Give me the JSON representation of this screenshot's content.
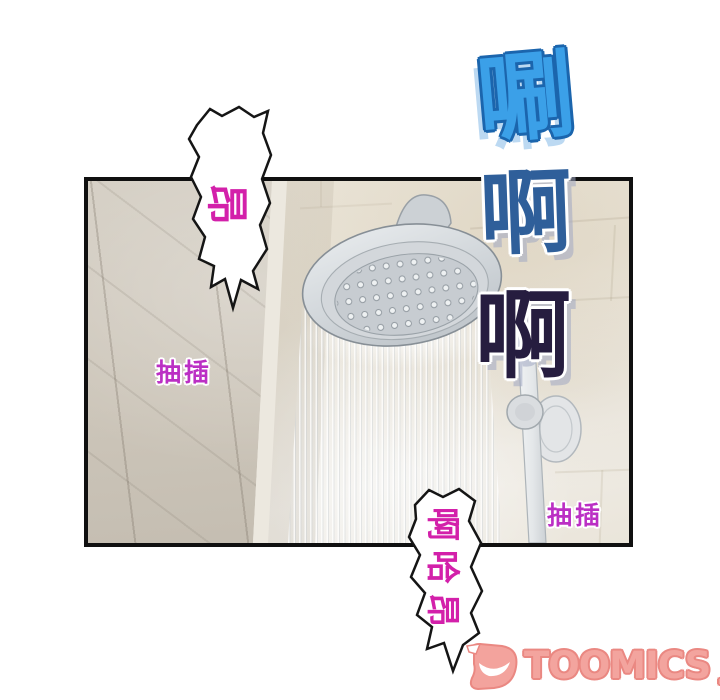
{
  "colors": {
    "page-bg": "#ffffff",
    "panel-border": "#101010",
    "wall-light": "#eae5d9",
    "wall-dark": "#cdc7bb",
    "sfx-shua-fill": "#3ba0e8",
    "sfx-shua-outline": "#1b65ad",
    "sfx-shua-shadow": "#bcd9f2",
    "sfx-ah1-fill": "#2f5f9a",
    "sfx-ah2-fill": "#261d3f",
    "moan-pink": "#d320aa",
    "chouicha-magenta": "#bb2fc4",
    "logo-fill": "#f3a49e",
    "logo-outline": "#ea8882",
    "fixture-gray": "#d6dadd"
  },
  "sfx": {
    "shua": {
      "text": "唰"
    },
    "ah_top": {
      "text": "啊"
    },
    "ah_bottom": {
      "text": "啊"
    },
    "thrust_left": {
      "text": "抽插"
    },
    "thrust_right": {
      "text": "抽插"
    }
  },
  "bubbles": {
    "top": {
      "text": "昂"
    },
    "bottom": {
      "chars": [
        "啊",
        "哈",
        "昂"
      ]
    }
  },
  "watermark": {
    "brand": "TOOMICS",
    "suffix": ".com"
  }
}
